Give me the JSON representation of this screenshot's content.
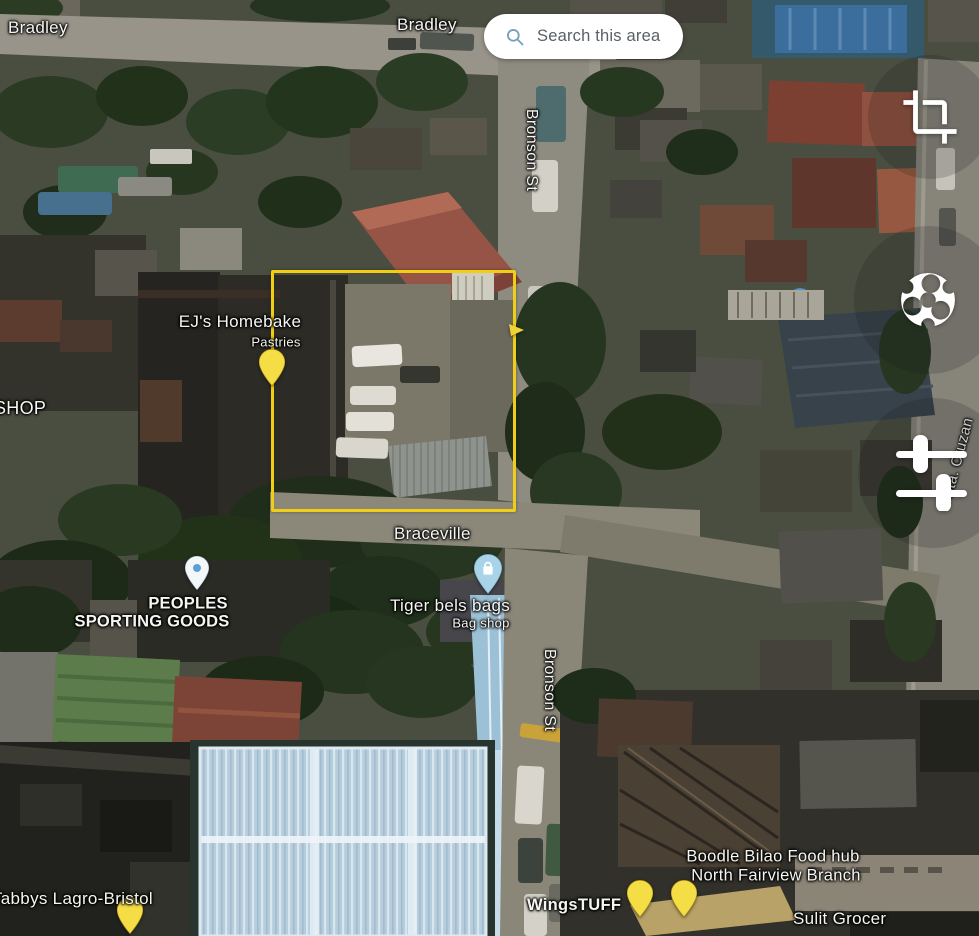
{
  "search_pill": {
    "label": "Search this area",
    "icon": "magnifier",
    "icon_color": "#76a0bb"
  },
  "labels": {
    "bradley_left": "Bradley",
    "bradley_center": "Bradley",
    "bronson_st_upper": "Bronson St",
    "bronson_st_lower": "Bronson St",
    "shop_partial": "SHOP",
    "ejs_homebake": {
      "line1": "EJ's Homebake",
      "line2": "Pastries"
    },
    "braceville": "Braceville",
    "peoples": {
      "line1": "PEOPLES",
      "line2": "SPORTING GOODS"
    },
    "tiger_bels": {
      "line1": "Tiger bels bags",
      "line2": "Bag shop"
    },
    "boodle": {
      "line1": "Boodle Bilao Food hub",
      "line2": "North Fairview Branch"
    },
    "tabbys": "Tabbys Lagro-Bristol",
    "wingstuff": "WingsTUFF",
    "sulit": "Sulit Grocer",
    "sta_cruzan": "Sta. Cruzan"
  },
  "selection": {
    "color": "#f0ce16"
  },
  "pins": {
    "ejs": {
      "name": "ejs-homebake-pin",
      "color": "#f4dd45"
    },
    "peoples": {
      "name": "peoples-pin",
      "color": "#f3f7fa",
      "glyph_color": "#5b9fd4"
    },
    "tiger": {
      "name": "tiger-bels-pin",
      "color": "#a9d3e8"
    },
    "tabbys": {
      "name": "tabbys-pin",
      "color": "#f4dd45"
    },
    "boodle1": {
      "name": "boodle-pin-1",
      "color": "#f4dd45"
    },
    "boodle2": {
      "name": "boodle-pin-2",
      "color": "#f4dd45"
    }
  },
  "toolbar": {
    "icons": [
      "crop",
      "rotate",
      "adjust"
    ]
  }
}
